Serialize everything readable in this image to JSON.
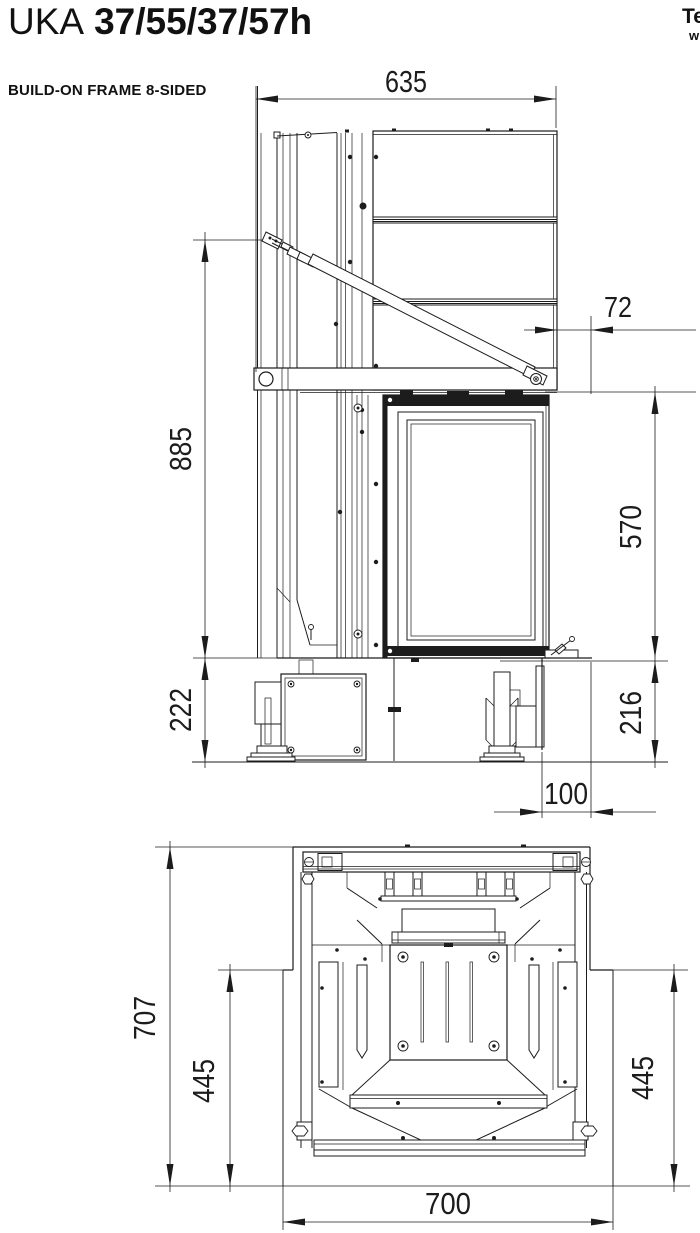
{
  "page": {
    "background": "#ffffff",
    "line_color": "#1c1c1c"
  },
  "header": {
    "product_series": "UKA",
    "product_model": "37/55/37/57h",
    "variant_label": "BUILD-ON FRAME 8-SIDED",
    "corner_note_line1": "Te",
    "corner_note_line2": "w"
  },
  "side_view": {
    "dims": {
      "top_width": "635",
      "front_offset": "72",
      "frame_height": "885",
      "door_height": "570",
      "base_height_left": "222",
      "base_height_right": "216",
      "base_front_offset": "100"
    }
  },
  "plan_view": {
    "dims": {
      "total_depth": "707",
      "side_depth_left": "445",
      "side_depth_right": "445",
      "total_width": "700"
    }
  }
}
